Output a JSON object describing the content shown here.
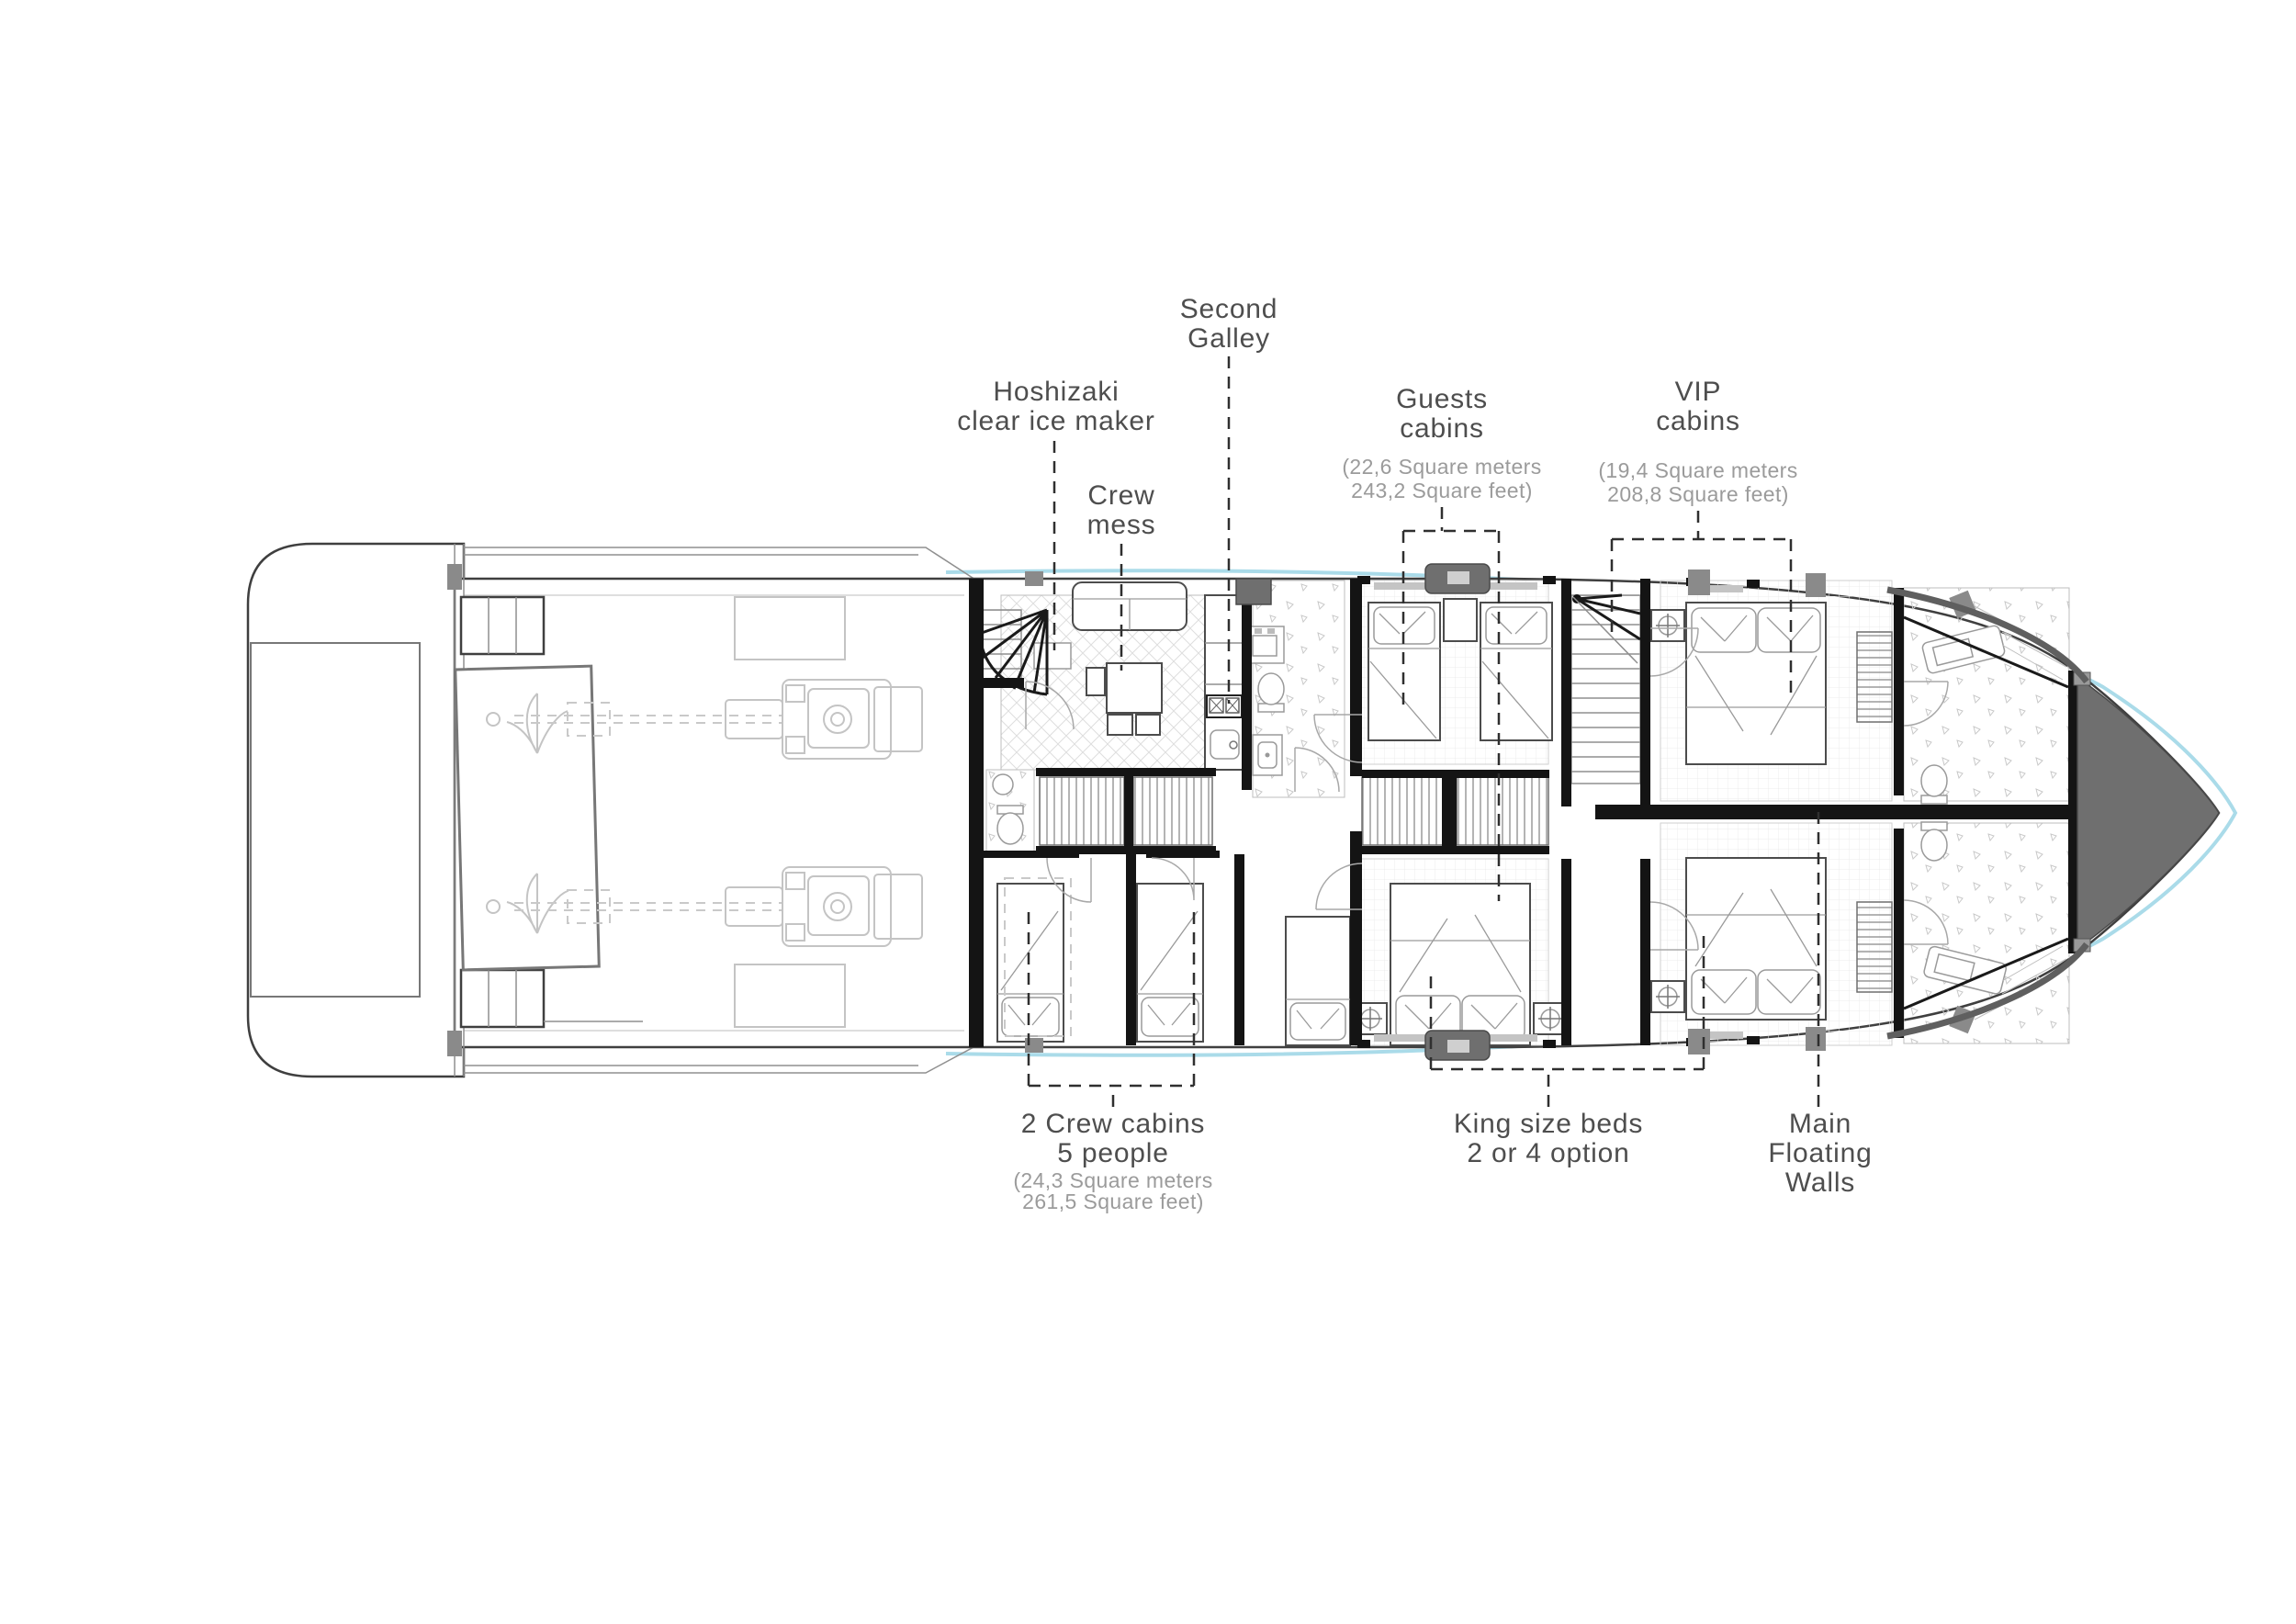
{
  "drawing": {
    "type": "yacht-lower-deck-floor-plan",
    "background": "#ffffff",
    "colors": {
      "hull_line": "#3f3f3f",
      "hull_accent": "#aadbe9",
      "bow_fill": "#6f6f6f",
      "wall_fill": "#141414",
      "label_text": "#4e4e4e",
      "sublabel_text": "#9b9b9b",
      "annotation_line": "#2f2f2f",
      "faint_equipment": "#c4c4c4"
    }
  },
  "annotations": {
    "second_galley": {
      "lines": [
        "Second",
        "Galley"
      ]
    },
    "hoshizaki": {
      "lines": [
        "Hoshizaki",
        "clear ice maker"
      ]
    },
    "crew_mess": {
      "lines": [
        "Crew",
        "mess"
      ]
    },
    "guests_cabins": {
      "title_lines": [
        "Guests",
        "cabins"
      ],
      "size_lines": [
        "(22,6 Square meters",
        "243,2 Square feet)"
      ]
    },
    "vip_cabins": {
      "title_lines": [
        "VIP",
        "cabins"
      ],
      "size_lines": [
        "(19,4 Square meters",
        "208,8 Square feet)"
      ]
    },
    "crew_cabins": {
      "title_lines": [
        "2 Crew cabins",
        "5 people"
      ],
      "size_lines": [
        "(24,3 Square meters",
        "261,5 Square feet)"
      ]
    },
    "king_size_beds": {
      "lines": [
        "King size beds",
        "2 or 4 option"
      ]
    },
    "main_floating_walls": {
      "lines": [
        "Main",
        "Floating",
        "Walls"
      ]
    }
  }
}
